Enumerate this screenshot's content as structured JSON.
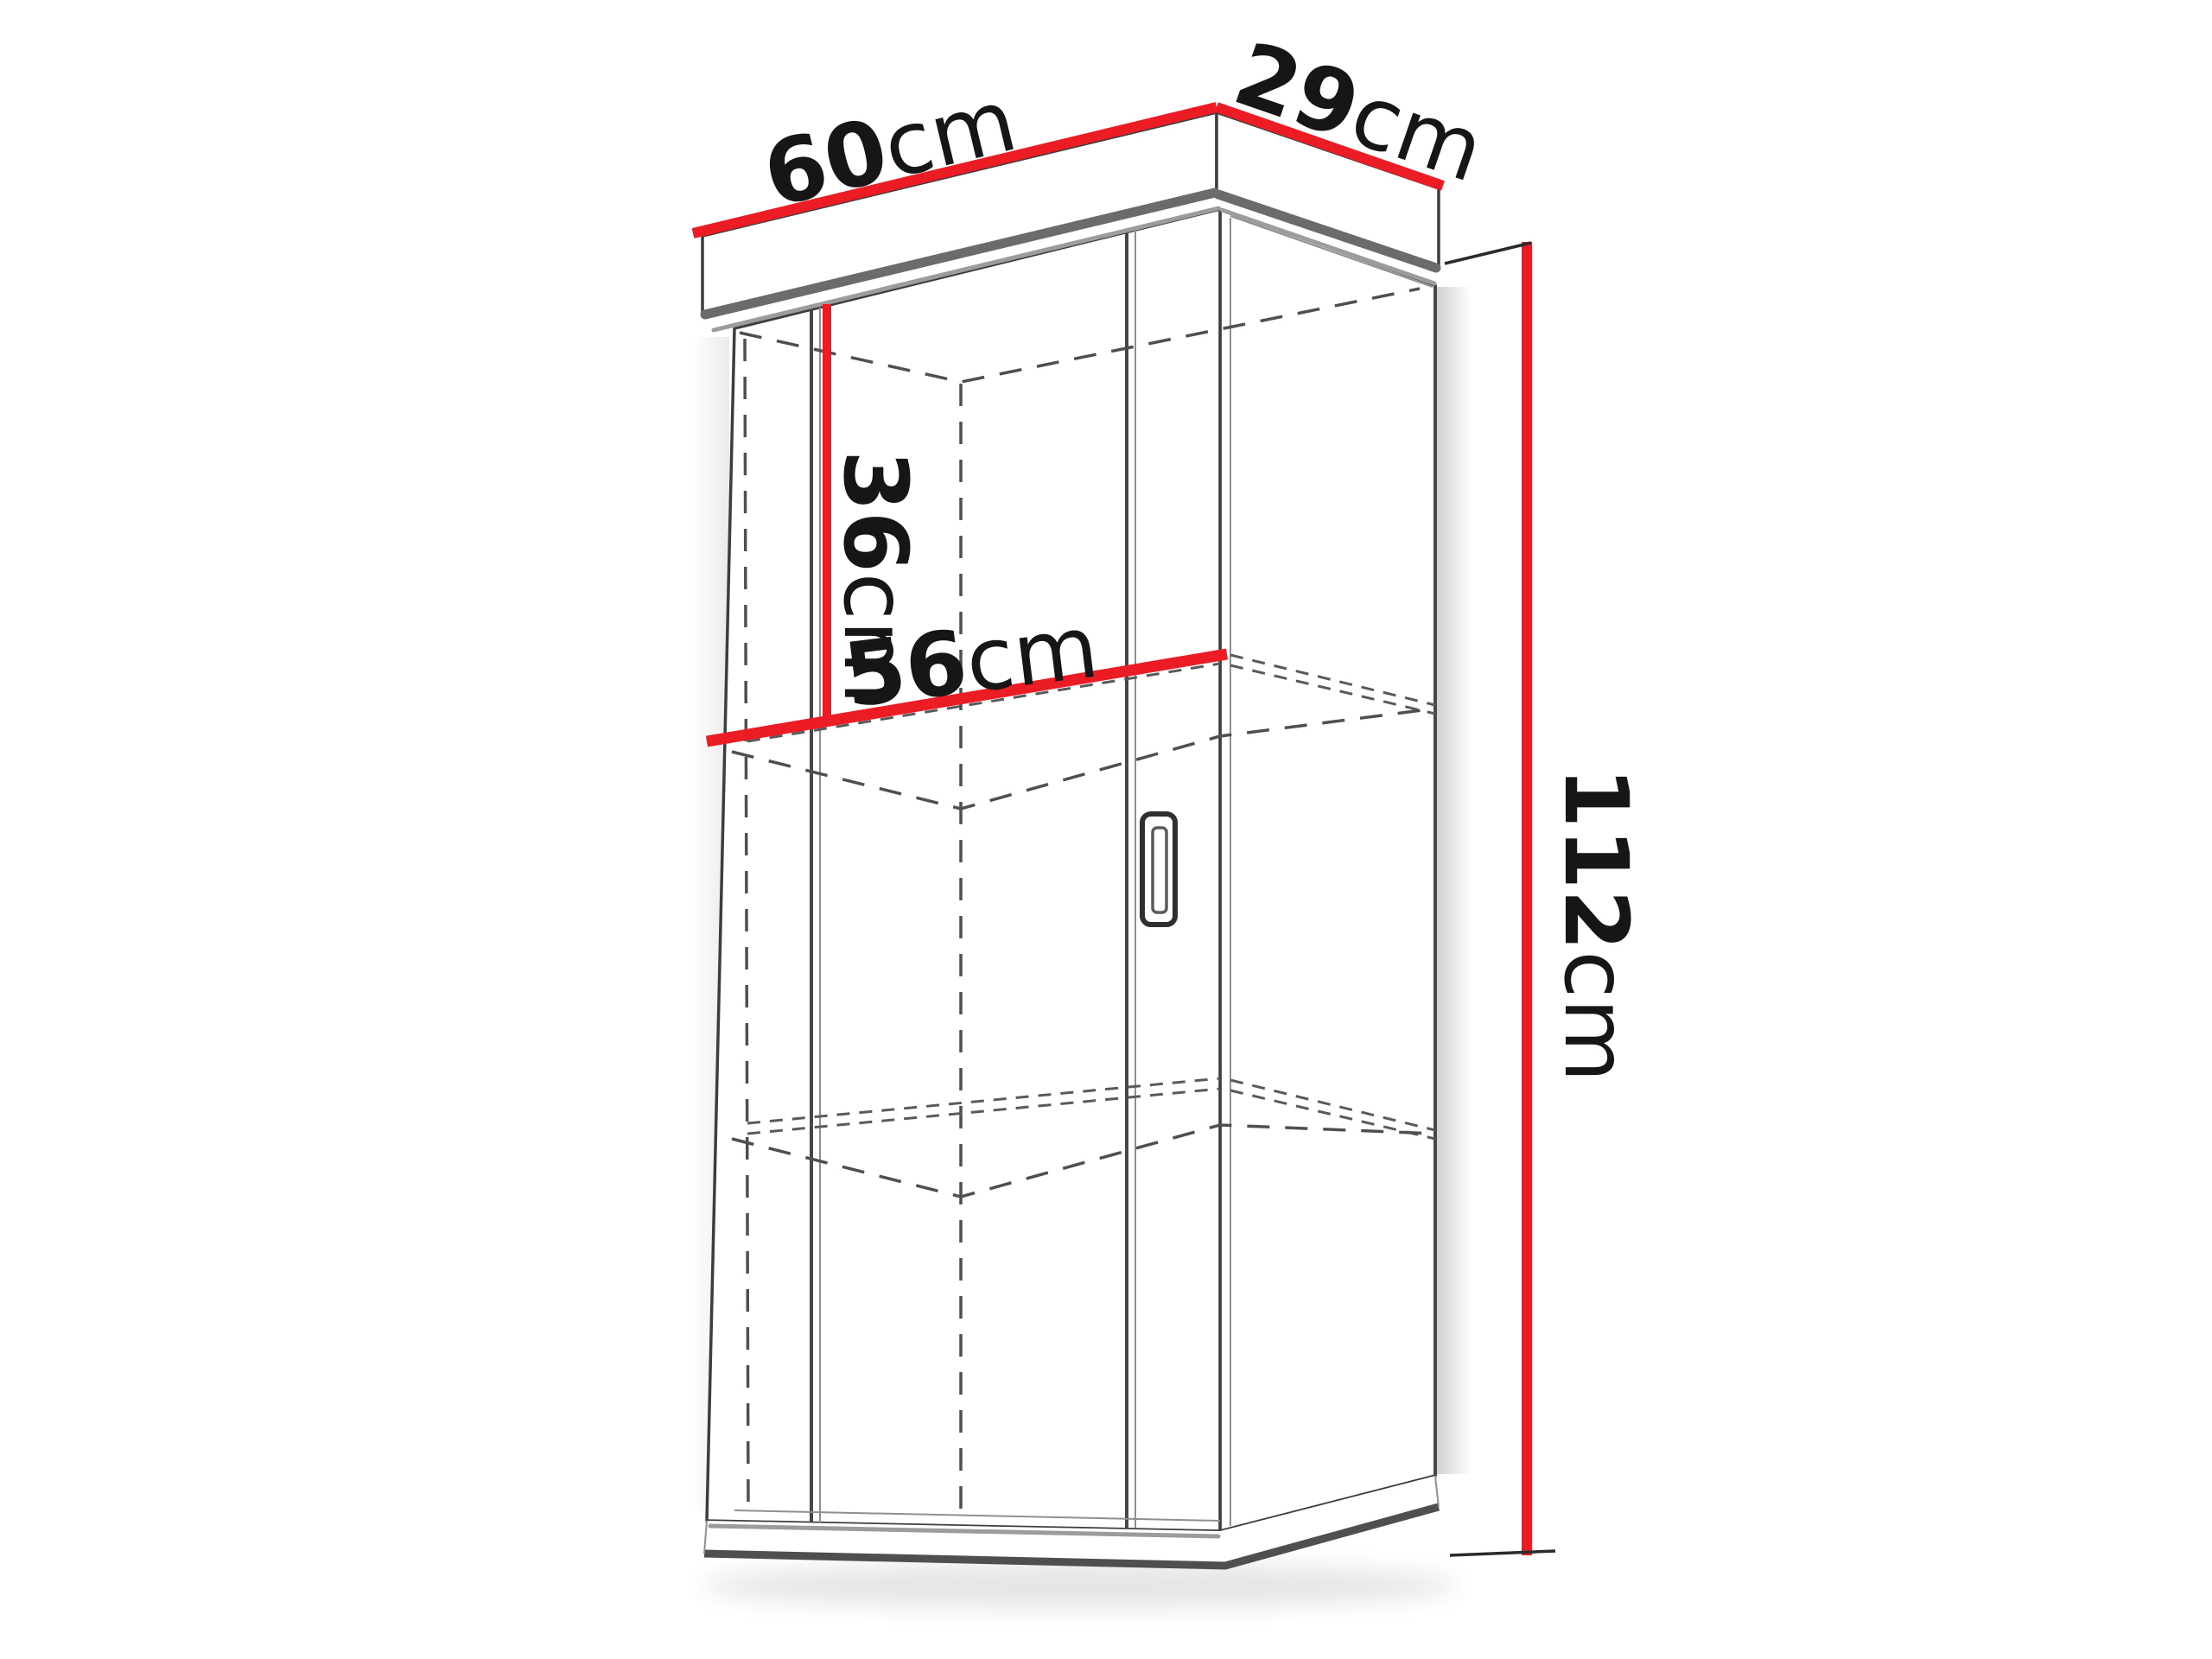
{
  "diagram": {
    "type": "furniture-dimension-drawing",
    "subject": "wall-hung cabinet with door, crown top and two hidden shelves",
    "background_color": "#ffffff",
    "dimension_color": "#ec1c24",
    "line_color": "#3d3d3d",
    "labels": {
      "width": {
        "num": "60",
        "unit": "cm"
      },
      "depth": {
        "num": "29",
        "unit": "cm"
      },
      "inner_height": {
        "num": "36",
        "unit": "cm"
      },
      "inner_width": {
        "num": "56",
        "unit": "cm"
      },
      "height": {
        "num": "112",
        "unit": "cm"
      }
    }
  }
}
